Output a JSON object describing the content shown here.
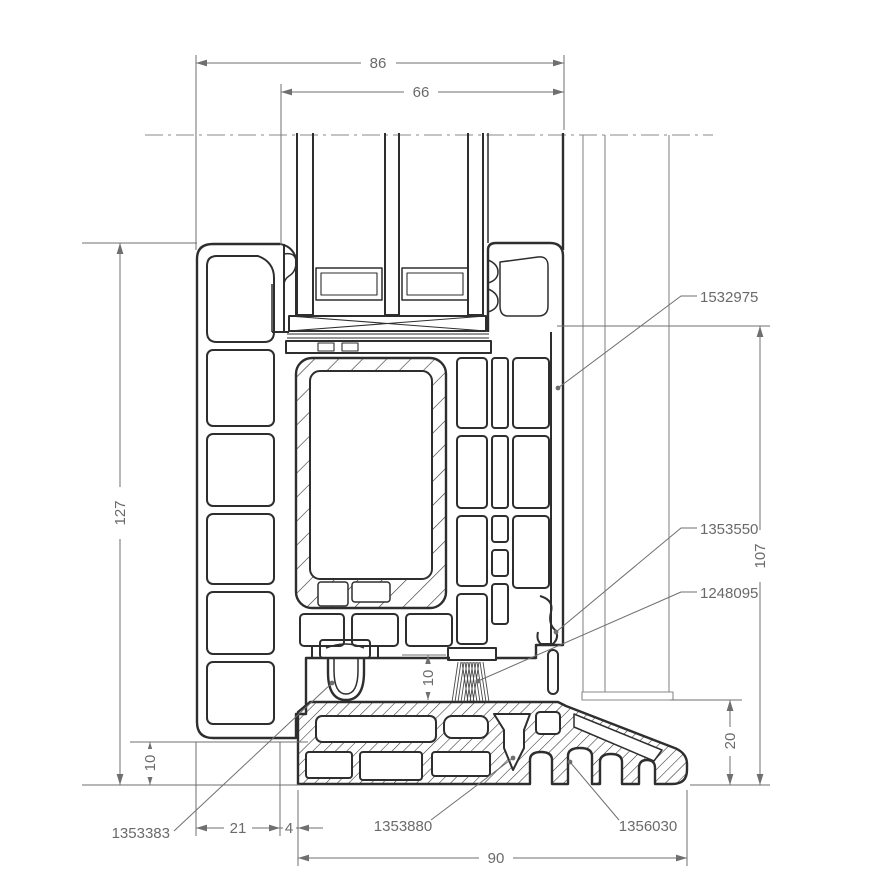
{
  "drawing": {
    "dimensions": {
      "overall_width": "86",
      "glazing_width": "66",
      "frame_height": "127",
      "right_height": "107",
      "brush_gap": "10",
      "frame_to_sill": "10",
      "sill_edge_height": "20",
      "bottom_left_offset": "21",
      "bottom_gap": "4",
      "sill_width": "90"
    },
    "part_numbers": {
      "sash_profile": "1532975",
      "center_gasket": "1353550",
      "brush_seal": "1248095",
      "frame_profile": "1353383",
      "drain_screw": "1353880",
      "sill_profile": "1356030"
    },
    "colors": {
      "profile_line": "#2e2e2e",
      "dimension_line": "#6f6f6f",
      "annotation_text": "#6a6a6a",
      "background": "#ffffff"
    }
  }
}
